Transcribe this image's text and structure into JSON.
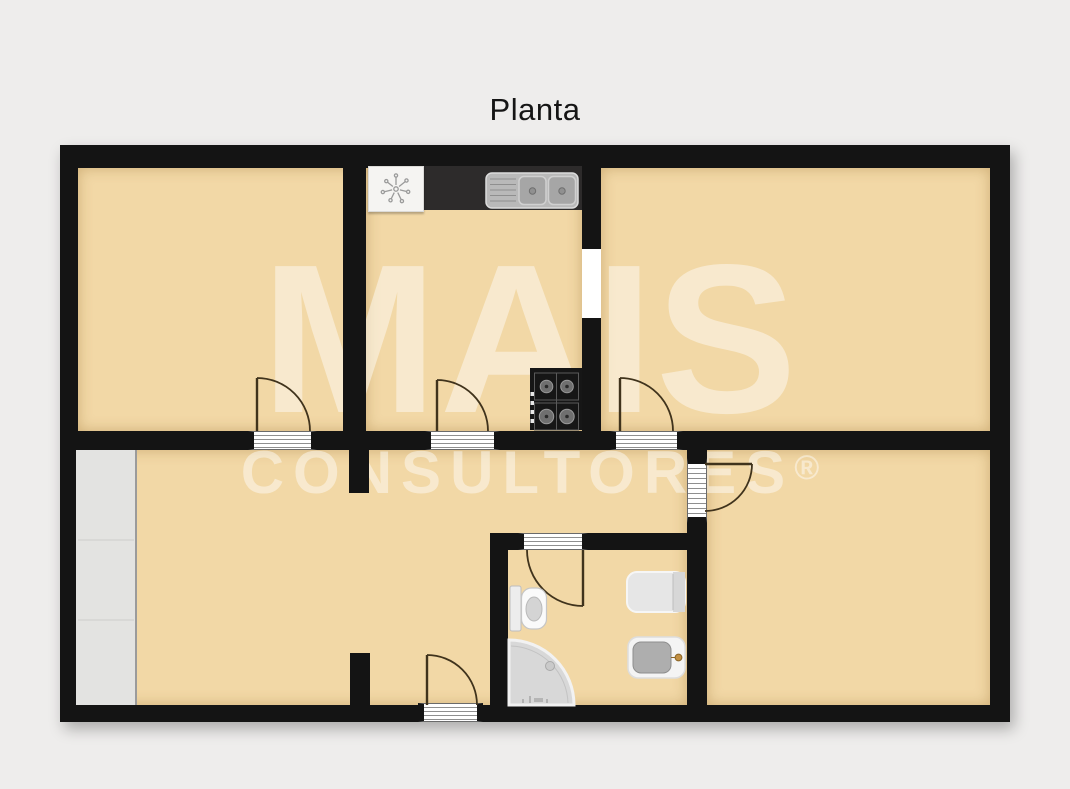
{
  "title": "Planta",
  "watermark": {
    "line1": "MAIS",
    "line2": "CONSULTORES",
    "registered": "®"
  },
  "palette": {
    "background": "#eeedec",
    "floor": "#f2d8a6",
    "wall": "#141414",
    "door_stroke": "#40331c",
    "watermark_color": "rgba(255,255,255,0.45)",
    "closet_gray": "#e3e3e1",
    "counter_dark": "#2d2b2b",
    "stainless_steel": "#b9b9b9",
    "faucet_gold": "#c39043"
  }
}
